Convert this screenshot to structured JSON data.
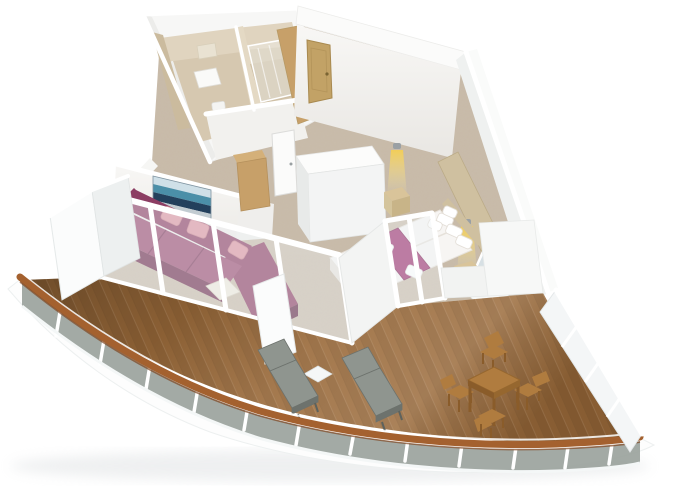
{
  "scene": {
    "type": "3d-floorplan-render",
    "subject": "cruise-ship suite with wrap-around balcony, isometric dollhouse view",
    "background": "#ffffff"
  },
  "rooms": [
    {
      "name": "bathroom",
      "features": [
        "tan tiled walls",
        "toilet",
        "vanity",
        "mirror-cabinet"
      ]
    },
    {
      "name": "shower-room",
      "features": [
        "glass shower enclosure"
      ]
    },
    {
      "name": "entrance-hall",
      "features": [
        "wood entry door",
        "wood closet wall",
        "carpet"
      ]
    },
    {
      "name": "living-room",
      "features": [
        "purple sectional sofa",
        "pink pillows",
        "seascape artwork",
        "coffee table",
        "table lamp",
        "sliding glass doors"
      ]
    },
    {
      "name": "bedroom",
      "features": [
        "double bed",
        "magenta bed runner",
        "folded towels",
        "two nightstands",
        "two lit wall sconces",
        "wood headboard wall",
        "mirror",
        "desk",
        "white wardrobe"
      ]
    },
    {
      "name": "balcony",
      "features": [
        "curved teak deck",
        "glass railing with wood cap",
        "two loungers",
        "white side table",
        "wood dining table with four chairs",
        "privacy divider",
        "white hull below"
      ]
    }
  ],
  "colors": {
    "background": "#ffffff",
    "deck_wood": "#9a6a3a",
    "handrail": "#a4612f",
    "handrail_dark": "#7e4520",
    "railing_glass": "#99a19b",
    "railing_panel": "#f4f6f7",
    "hull": "#fdfdfd",
    "carpet": "#c9bcab",
    "wall_white": "#f3f4f4",
    "tile": "#e0d4bf",
    "tile_floor": "#d6c8b0",
    "door_wood": "#c2a266",
    "closet_wood": "#c7a069",
    "sofa": "#8c3d63",
    "sofa_seat": "#9a4a71",
    "sofa_dark": "#6e2c4e",
    "pillow_pink": "#dd93a0",
    "art_sky": "#cfe0e8",
    "art_teal": "#4b8fa8",
    "art_navy": "#23405c",
    "art_base": "#c2ccd1",
    "bed_white": "#f7f5f3",
    "runner": "#9c2d6d",
    "nightstand": "#d9c49a",
    "headboard_wood": "#cfc0a0",
    "lamp_glow": "#f4ce54",
    "lounger": "#8f958f",
    "dining_wood": "#b07c3f",
    "divider_white": "#fbfcfc"
  }
}
